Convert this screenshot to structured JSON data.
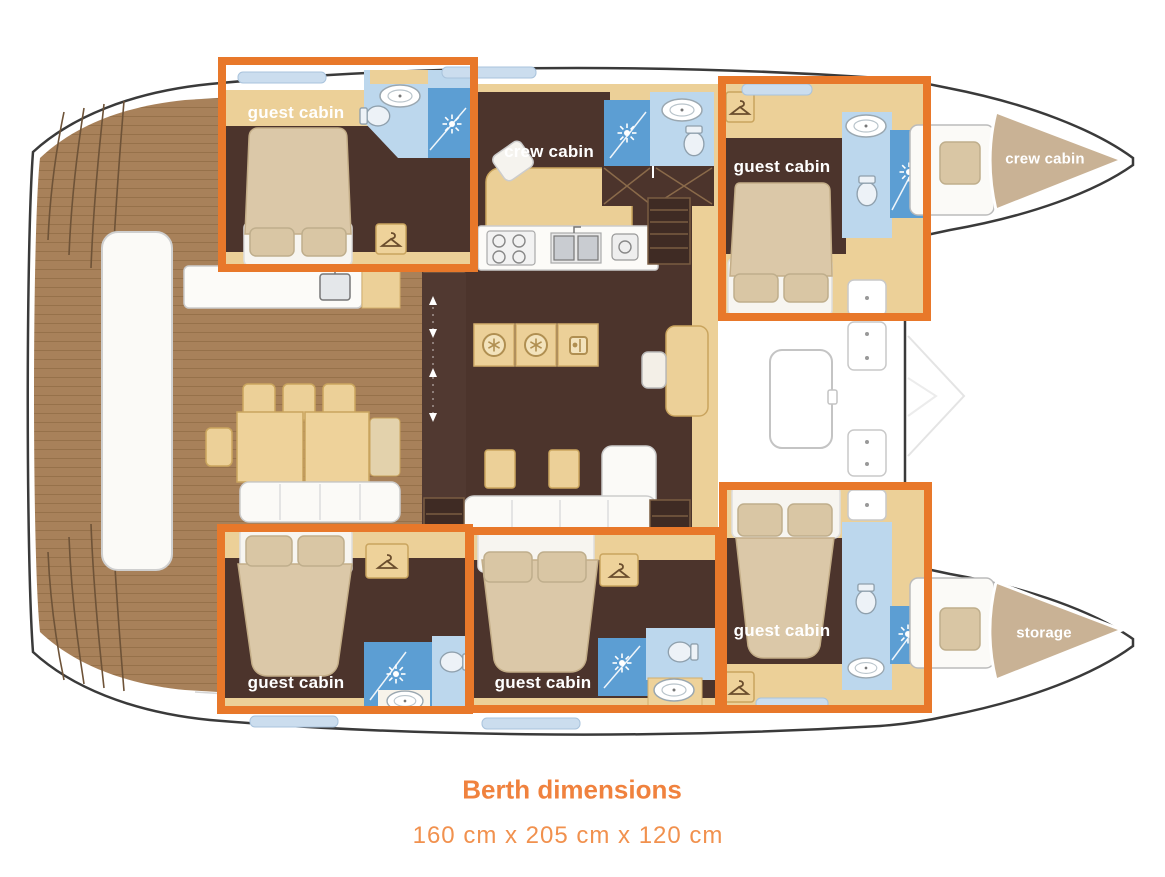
{
  "caption": {
    "title": "Berth dimensions",
    "dimensions": "160 cm x 205 cm x 120 cm"
  },
  "cabin_labels": [
    {
      "id": "guest-cabin-top-left",
      "text": "guest cabin"
    },
    {
      "id": "crew-cabin-center",
      "text": "crew cabin"
    },
    {
      "id": "guest-cabin-top-right",
      "text": "guest cabin"
    },
    {
      "id": "crew-cabin-bow",
      "text": "crew cabin"
    },
    {
      "id": "guest-cabin-bottom-left",
      "text": "guest cabin"
    },
    {
      "id": "guest-cabin-bottom-middle",
      "text": "guest cabin"
    },
    {
      "id": "guest-cabin-bottom-right",
      "text": "guest cabin"
    },
    {
      "id": "storage-bow",
      "text": "storage"
    }
  ],
  "highlights": {
    "count": 5,
    "meaning": "highlighted guest berths",
    "color": "#E8782A"
  },
  "colors": {
    "highlight_orange": "#E8782A",
    "caption_title_orange": "#F0823E",
    "caption_text_orange": "#F1914E",
    "cabin_floor_brown": "#4C342C",
    "deck_wood_brown": "#A8815A",
    "furniture_tan": "#ECD098",
    "bed_beige": "#DBC8A8",
    "bathroom_blue_light": "#BCD7ED",
    "bathroom_blue_dark": "#5C9ED3",
    "bow_cushion_tan": "#C9B295",
    "label_text": "#FFFFFF"
  }
}
